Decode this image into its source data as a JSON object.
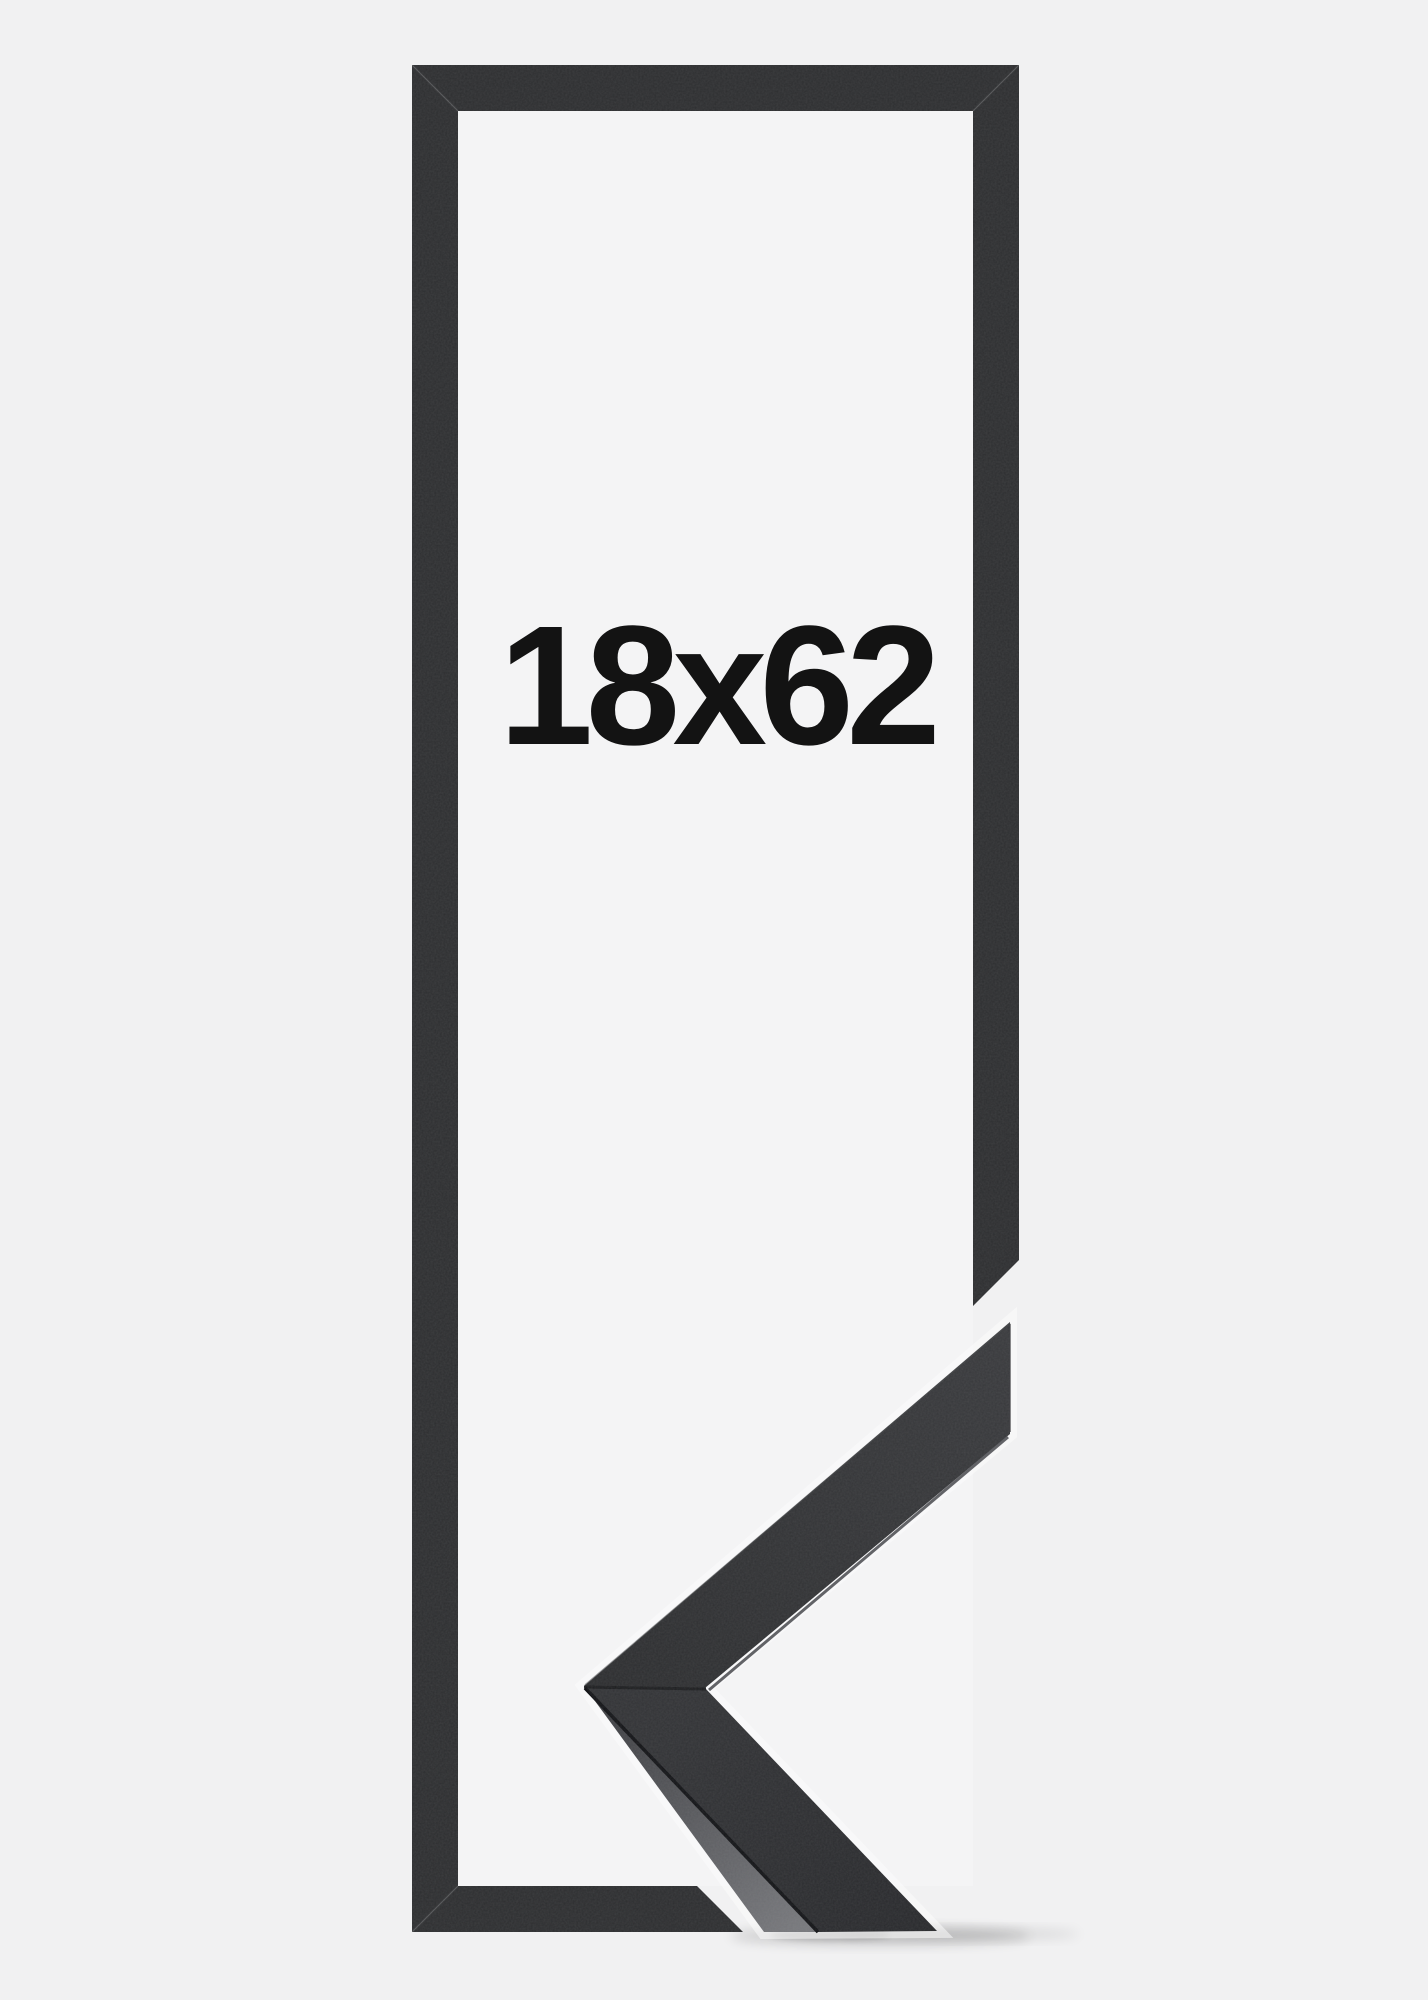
{
  "frame_preview": {
    "size_label": "18x62"
  },
  "colors": {
    "bg": "#f1f1f2",
    "mat": "#f4f4f5",
    "frame": "#2d2e30",
    "label": "#131313",
    "leg-top-light": "#393a3d",
    "leg-top-dark": "#2c2d2f",
    "side-dark": "#3a3b3f",
    "side-light": "#77787c",
    "halo": "#fbfbfc"
  }
}
